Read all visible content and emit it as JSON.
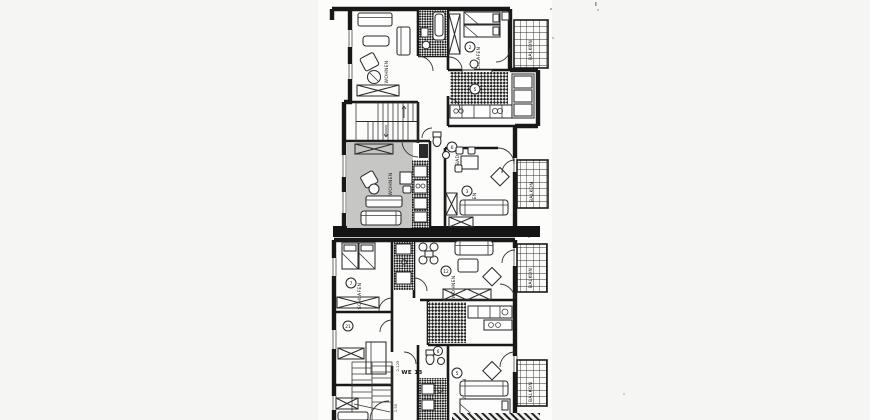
{
  "canvas": {
    "page_bg": "#f5f5f4",
    "scan_bg": "#fcfcfb",
    "ink": "#181818",
    "highlight_fill": "#c6c6c4"
  },
  "upper_plan": {
    "living_tl_label": "WOHNEN",
    "bedroom_label": "SCHLAFEN",
    "bedroom_unit": "2",
    "balcony_top_label": "BALKON",
    "kitchen_unit": "5",
    "bath_label": "BAD",
    "bath_unit": "6",
    "highlight_living_label": "WOHNEN",
    "right_living_label": "WOHNEN",
    "right_living_unit": "3",
    "balcony_right_label": "BALKON"
  },
  "lower_plan": {
    "bedroom_label": "SCHLAFEN",
    "bedroom_unit": "7",
    "living_top_label": "WOHNEN",
    "living_top_unit": "12",
    "balcony_top_label": "BALKON",
    "small_room_unit": "21",
    "apartment_label": "WE 13",
    "dim_top": "2.125",
    "dim_bottom": "1.50",
    "bath_unit": "6",
    "living_bottom_label": "WOHNEN",
    "living_bottom_unit": "5",
    "balcony_bottom_label": "BALKON"
  }
}
